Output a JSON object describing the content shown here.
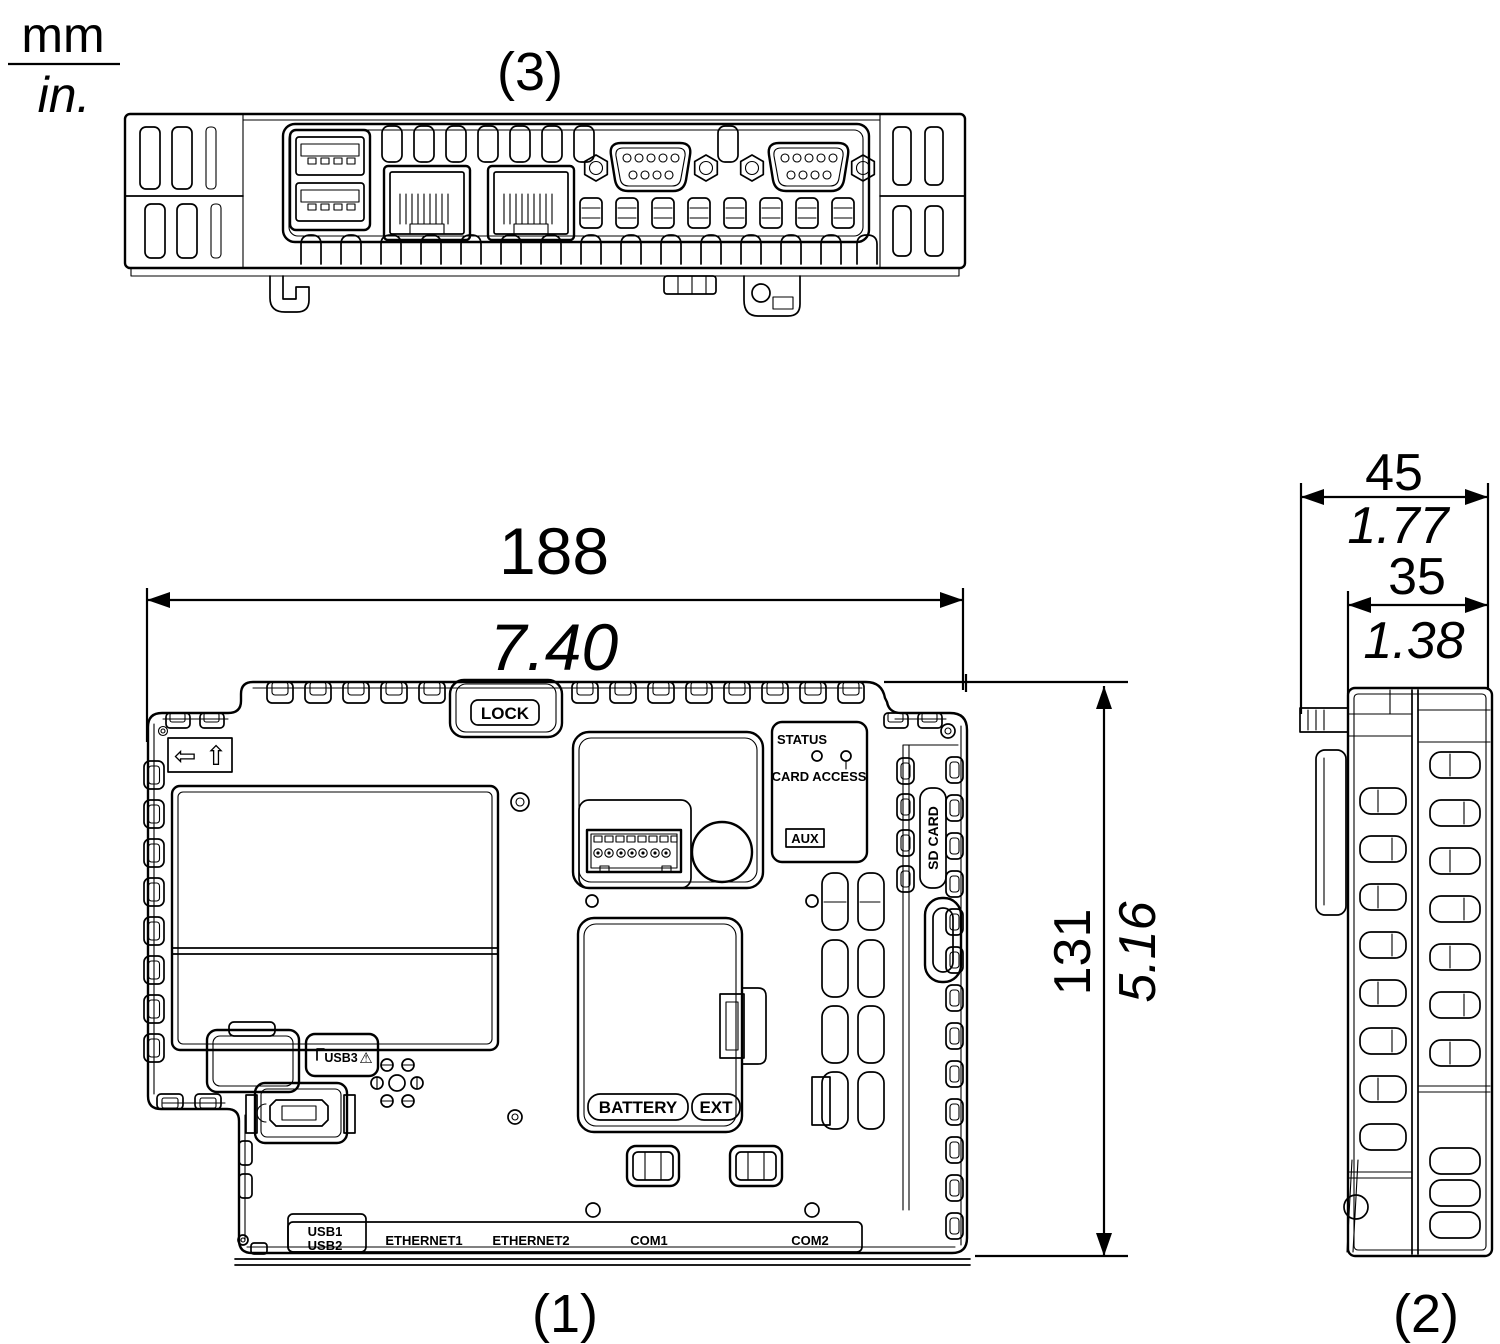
{
  "colors": {
    "line": "#000000",
    "background": "#ffffff"
  },
  "unit_note": {
    "numerator": "mm",
    "denominator": "in."
  },
  "view_labels": {
    "rear": "(1)",
    "side": "(2)",
    "top": "(3)"
  },
  "dimensions": {
    "width": {
      "mm": "188",
      "inches": "7.40"
    },
    "height": {
      "mm": "131",
      "inches": "5.16"
    },
    "depth_overall": {
      "mm": "45",
      "inches": "1.77"
    },
    "depth_body": {
      "mm": "35",
      "inches": "1.38"
    }
  },
  "rear_labels": {
    "lock": "LOCK",
    "status": "STATUS",
    "card_access": "CARD ACCESS",
    "aux": "AUX",
    "sd_card": "SD CARD",
    "usb3": "USB3",
    "battery": "BATTERY",
    "ext": "EXT",
    "usb1": "USB1",
    "usb2": "USB2",
    "ethernet1": "ETHERNET1",
    "ethernet2": "ETHERNET2",
    "com1": "COM1",
    "com2": "COM2"
  },
  "icons": {
    "left_arrow": "⇦",
    "up_arrow": "⇧",
    "warning": "⚠"
  }
}
